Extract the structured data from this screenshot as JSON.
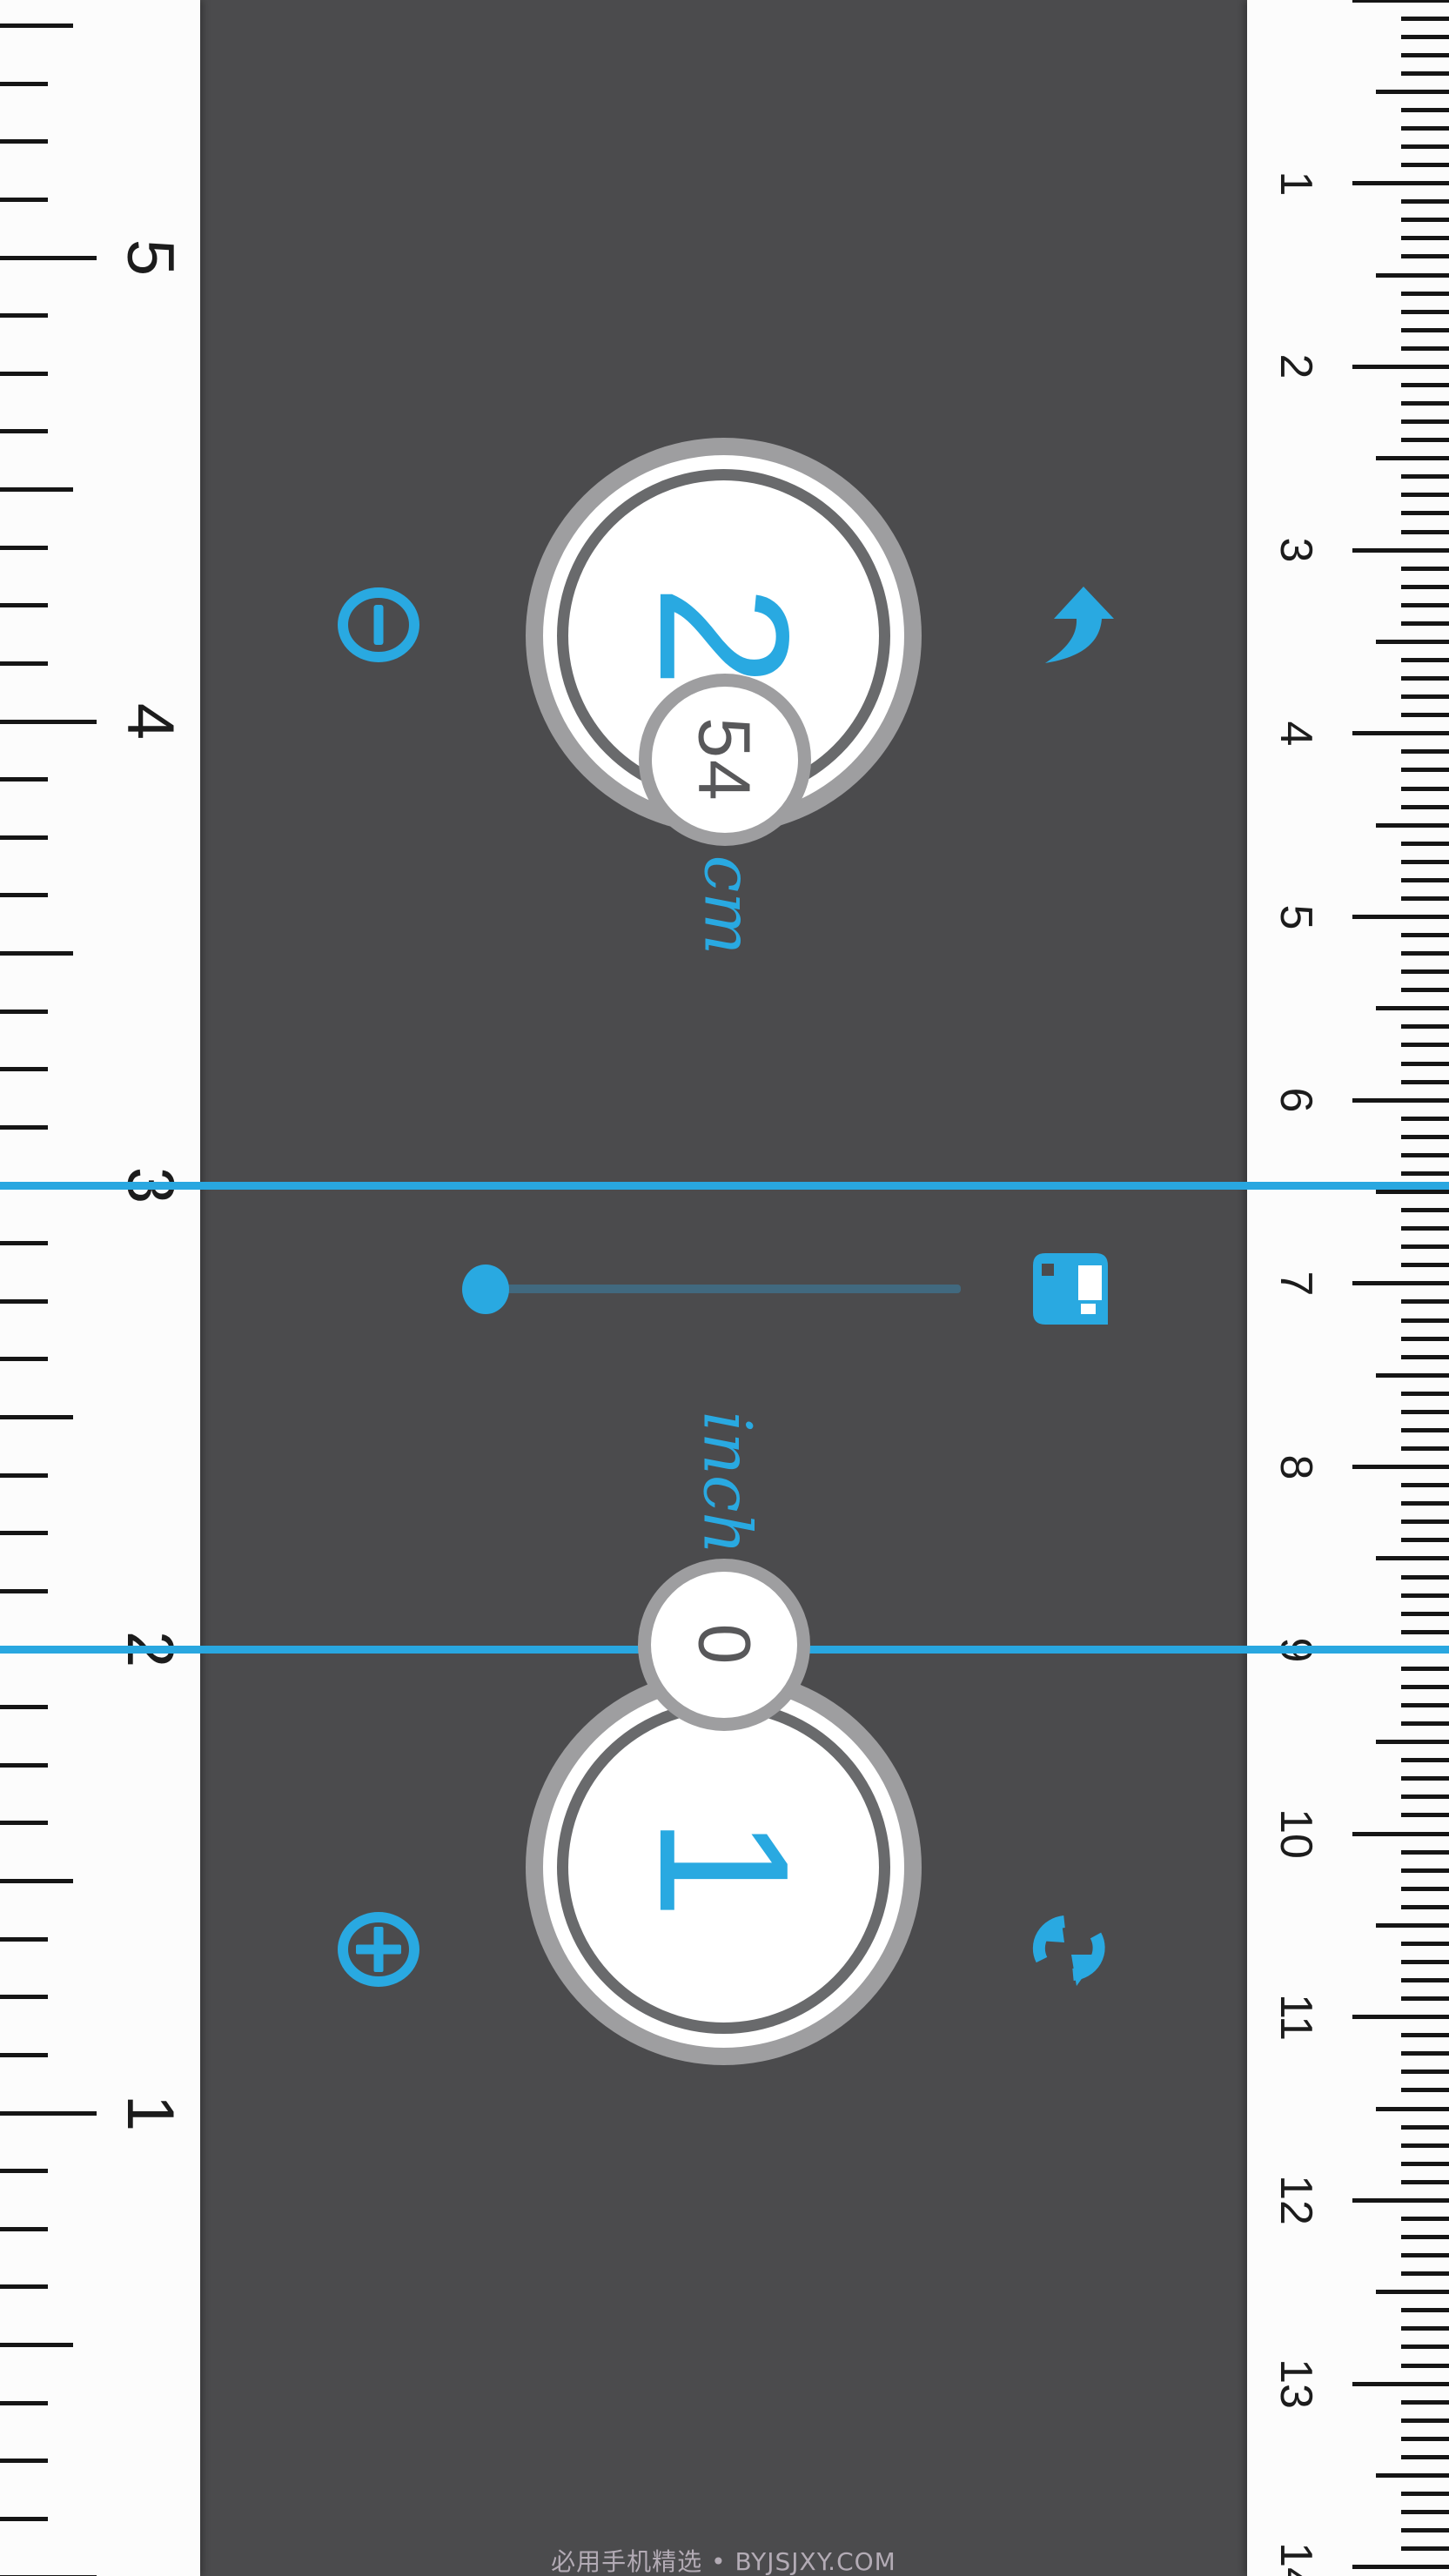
{
  "app": {
    "name": "ruler-app",
    "accent_color": "#29a9e1",
    "background_color": "#4b4b4d",
    "measure_line_color": "#29a7e0",
    "slider_track_color": "#41697f"
  },
  "left_ruler": {
    "unit": "inch",
    "labels": [
      "1",
      "2",
      "3",
      "4",
      "5"
    ],
    "subdivisions_per_unit": 8,
    "numbers_increase": "upward"
  },
  "right_ruler": {
    "unit": "cm",
    "labels": [
      "1",
      "2",
      "3",
      "4",
      "5",
      "6",
      "7",
      "8",
      "9",
      "10",
      "11",
      "12",
      "13",
      "14"
    ],
    "subdivisions_per_unit": 10,
    "numbers_increase": "downward"
  },
  "measurement": {
    "cm": {
      "integer": "2",
      "fraction": "54",
      "unit": "cm"
    },
    "inch": {
      "integer": "1",
      "fraction": "0",
      "unit": "inch"
    },
    "line_1_reading": {
      "inch": "3",
      "cm": "6.46"
    },
    "line_2_reading": {
      "inch": "2",
      "cm": "9"
    }
  },
  "controls": {
    "power_button": "power-icon",
    "undo_button": "curved-arrow-icon",
    "save_button": "floppy-disk-icon",
    "add_button": "plus-circle-icon",
    "rotate_button": "refresh-icon",
    "slider_position": "0"
  },
  "watermark": {
    "text": "必用手机精选 • BYJSJXY.COM"
  }
}
